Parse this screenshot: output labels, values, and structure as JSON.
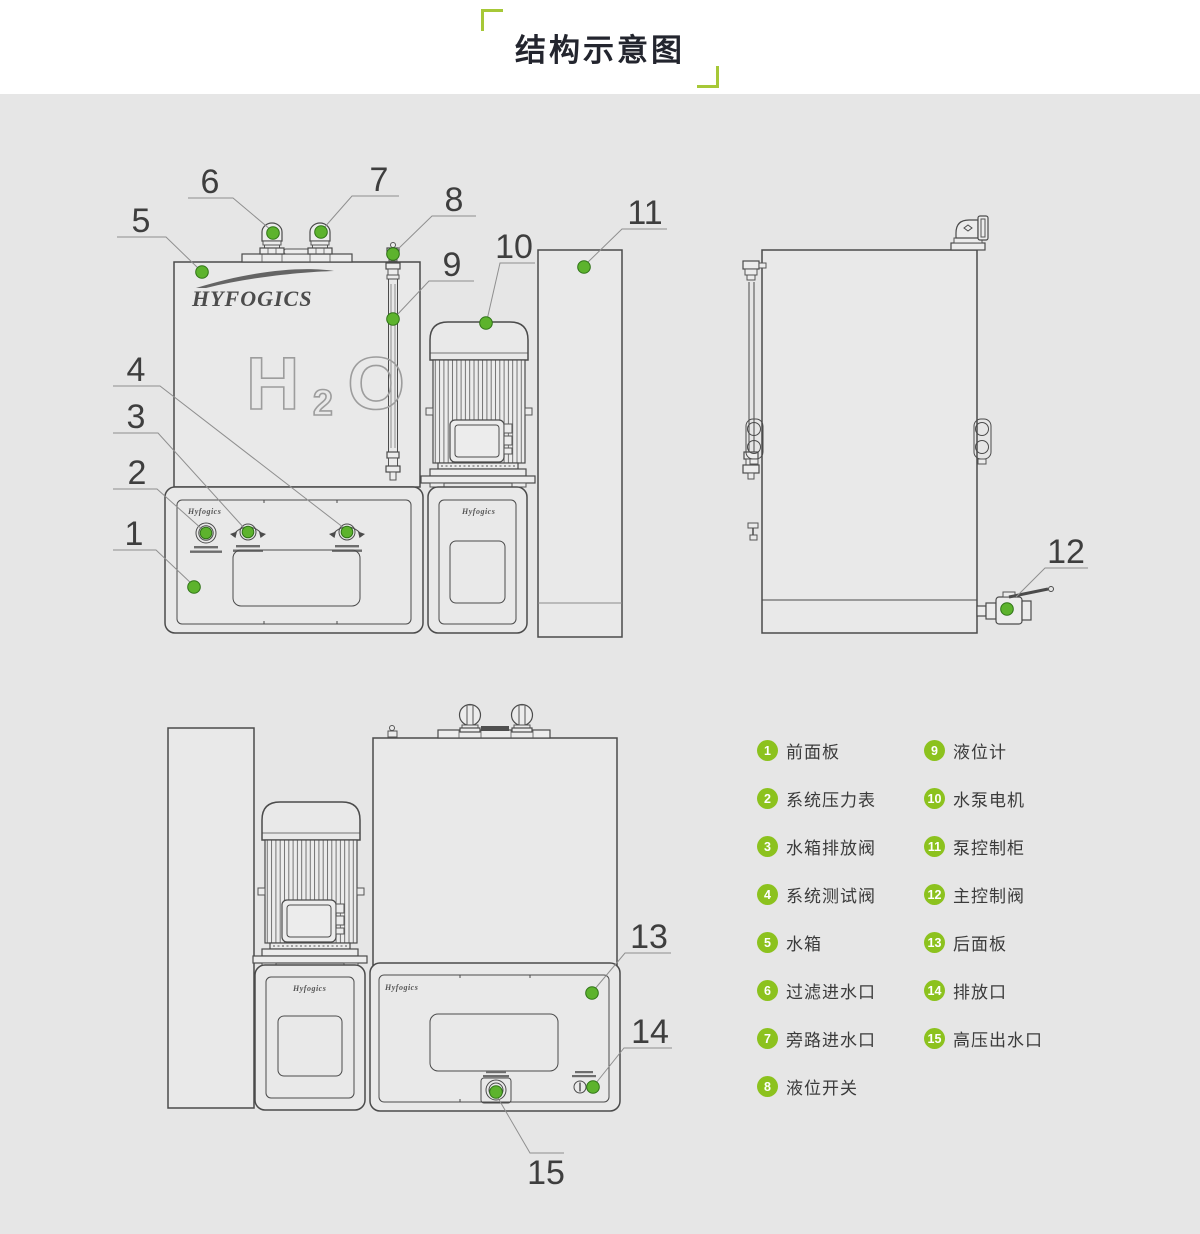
{
  "title": "结构示意图",
  "brand": {
    "logo": "HYFOGICS",
    "logo_small": "Hyfogics"
  },
  "tank_text": {
    "h": "H",
    "sub": "2",
    "o": "O"
  },
  "callouts": {
    "c1": "1",
    "c2": "2",
    "c3": "3",
    "c4": "4",
    "c5": "5",
    "c6": "6",
    "c7": "7",
    "c8": "8",
    "c9": "9",
    "c10": "10",
    "c11": "11",
    "c12": "12",
    "c13": "13",
    "c14": "14",
    "c15": "15"
  },
  "legend": {
    "col1": [
      {
        "num": "1",
        "label": "前面板"
      },
      {
        "num": "2",
        "label": "系统压力表"
      },
      {
        "num": "3",
        "label": "水箱排放阀"
      },
      {
        "num": "4",
        "label": "系统测试阀"
      },
      {
        "num": "5",
        "label": "水箱"
      },
      {
        "num": "6",
        "label": "过滤进水口"
      },
      {
        "num": "7",
        "label": "旁路进水口"
      },
      {
        "num": "8",
        "label": "液位开关"
      }
    ],
    "col2": [
      {
        "num": "9",
        "label": "液位计"
      },
      {
        "num": "10",
        "label": "水泵电机"
      },
      {
        "num": "11",
        "label": "泵控制柜"
      },
      {
        "num": "12",
        "label": "主控制阀"
      },
      {
        "num": "13",
        "label": "后面板"
      },
      {
        "num": "14",
        "label": "排放口"
      },
      {
        "num": "15",
        "label": "高压出水口"
      }
    ]
  },
  "colors": {
    "accent_green": "#8cc21e",
    "dot_green": "#5db32d",
    "bracket_green": "#a6c837",
    "background": "#e6e6e6",
    "line": "#4b4b4b"
  }
}
